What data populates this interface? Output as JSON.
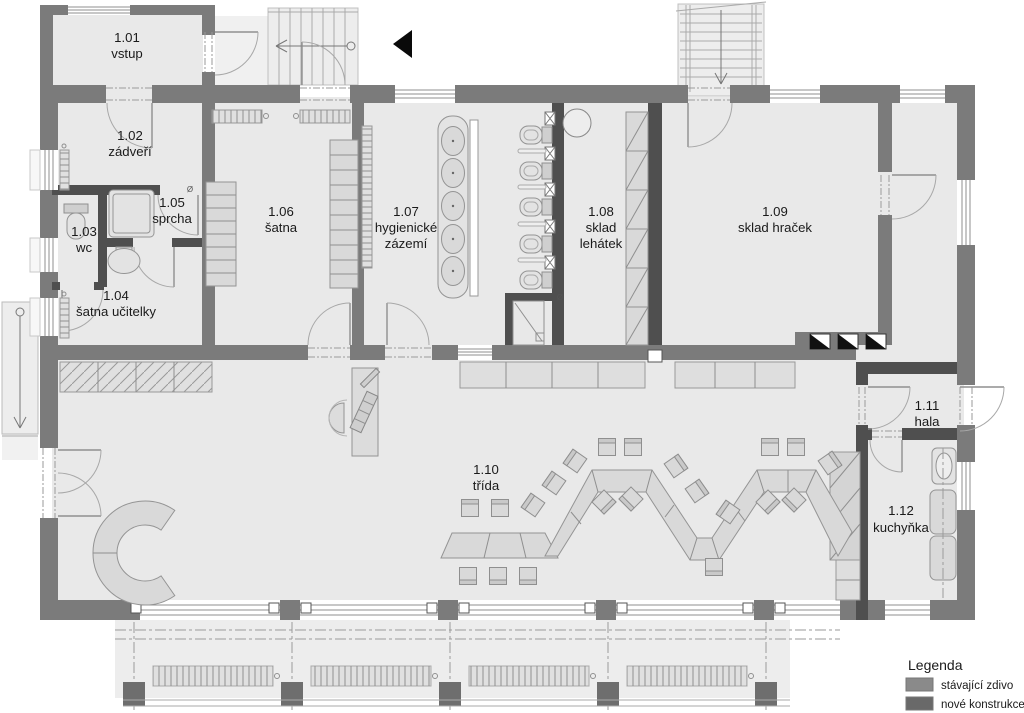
{
  "plan": {
    "rooms": [
      {
        "num": "1.01",
        "line1": "vstup"
      },
      {
        "num": "1.02",
        "line1": "zádveří"
      },
      {
        "num": "1.03",
        "line1": "wc"
      },
      {
        "num": "1.04",
        "line1": "šatna učitelky"
      },
      {
        "num": "1.05",
        "line1": "sprcha"
      },
      {
        "num": "1.06",
        "line1": "šatna"
      },
      {
        "num": "1.07",
        "line1": "hygienické",
        "line2": "zázemí"
      },
      {
        "num": "1.08",
        "line1": "sklad",
        "line2": "lehátek"
      },
      {
        "num": "1.09",
        "line1": "sklad hraček"
      },
      {
        "num": "1.10",
        "line1": "třída"
      },
      {
        "num": "1.11",
        "line1": "hala"
      },
      {
        "num": "1.12",
        "line1": "kuchyňka"
      }
    ],
    "symbols": {
      "diameter": "Ø"
    }
  },
  "legend": {
    "title": "Legenda",
    "items": [
      {
        "label": "stávající zdivo",
        "color": "#8a8a8a"
      },
      {
        "label": "nové konstrukce",
        "color": "#696969"
      }
    ]
  }
}
